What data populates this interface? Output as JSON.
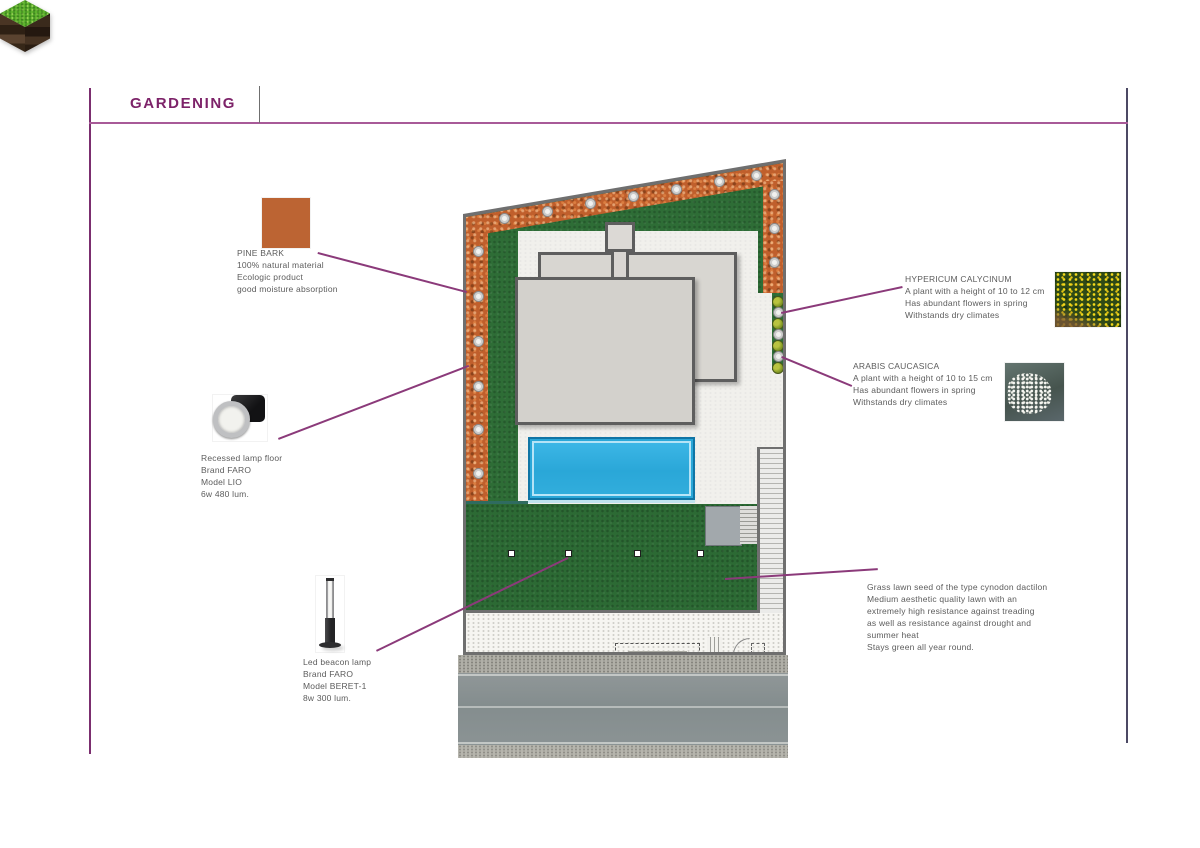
{
  "page": {
    "title": "GARDENING"
  },
  "colors": {
    "accent_purple": "#8b3a7a",
    "frame_purple": "#7b2e6f",
    "lawn_green": "#2e6d36",
    "bark_orange": "#c05f2c",
    "pool_blue": "#2aa7d8"
  },
  "callouts": {
    "pine_bark": {
      "title": "PINE BARK",
      "lines": [
        "100% natural material",
        "Ecologic product",
        "good moisture absorption"
      ]
    },
    "recessed_lamp": {
      "lines": [
        "Recessed lamp floor",
        "Brand FARO",
        "Model LIO",
        "6w 480 lum."
      ]
    },
    "beacon_lamp": {
      "lines": [
        "Led beacon lamp",
        "Brand FARO",
        "Model BERET-1",
        "8w 300 lum."
      ]
    },
    "hypericum": {
      "title": "HYPERICUM CALYCINUM",
      "lines": [
        "A plant with a height of 10 to 12 cm",
        "Has abundant flowers in spring",
        "Withstands dry climates"
      ]
    },
    "arabis": {
      "title": "ARABIS CAUCASICA",
      "lines": [
        "A plant with a height of 10 to 15 cm",
        "Has abundant flowers in spring",
        "Withstands dry climates"
      ]
    },
    "grass": {
      "lines": [
        "Grass lawn seed of the type cynodon dactilon",
        "Medium aesthetic quality lawn with an",
        "extremely high resistance against treading",
        "as well as resistance against drought and",
        "summer heat",
        "Stays green all year round."
      ]
    }
  }
}
